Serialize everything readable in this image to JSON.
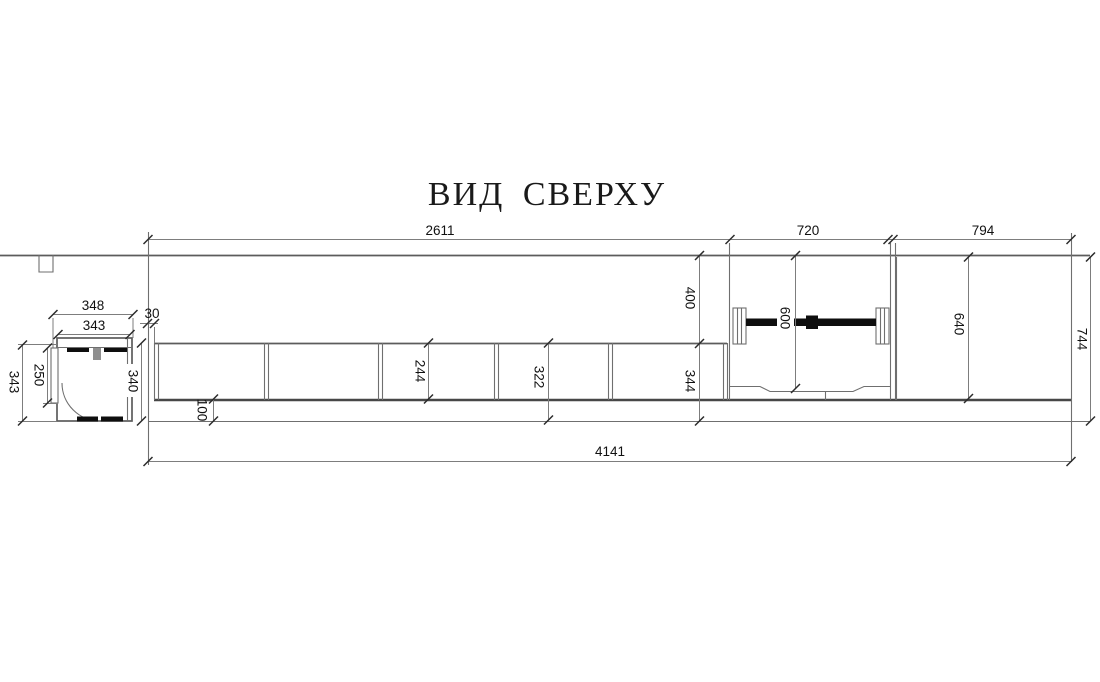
{
  "title": "ВИД СВЕРХУ",
  "dims": {
    "top_width_left": "2611",
    "top_width_middle": "720",
    "top_width_right": "794",
    "corner_width_outer": "348",
    "corner_width_inner": "343",
    "gap_30": "30",
    "corner_depth_left": "343",
    "corner_door_250": "250",
    "corner_depth_right": "340",
    "front_offset_100": "100",
    "depth_244": "244",
    "depth_322": "322",
    "depth_344": "344",
    "wall_to_front_400": "400",
    "rail_600": "600",
    "right_depth_640": "640",
    "total_depth_744": "744",
    "total_width_4141": "4141"
  },
  "colors": {
    "background": "#ffffff",
    "line_gray": "#6f6f6f",
    "line_dark": "#474747",
    "element_black": "#0e0e0e",
    "text": "#111111"
  }
}
